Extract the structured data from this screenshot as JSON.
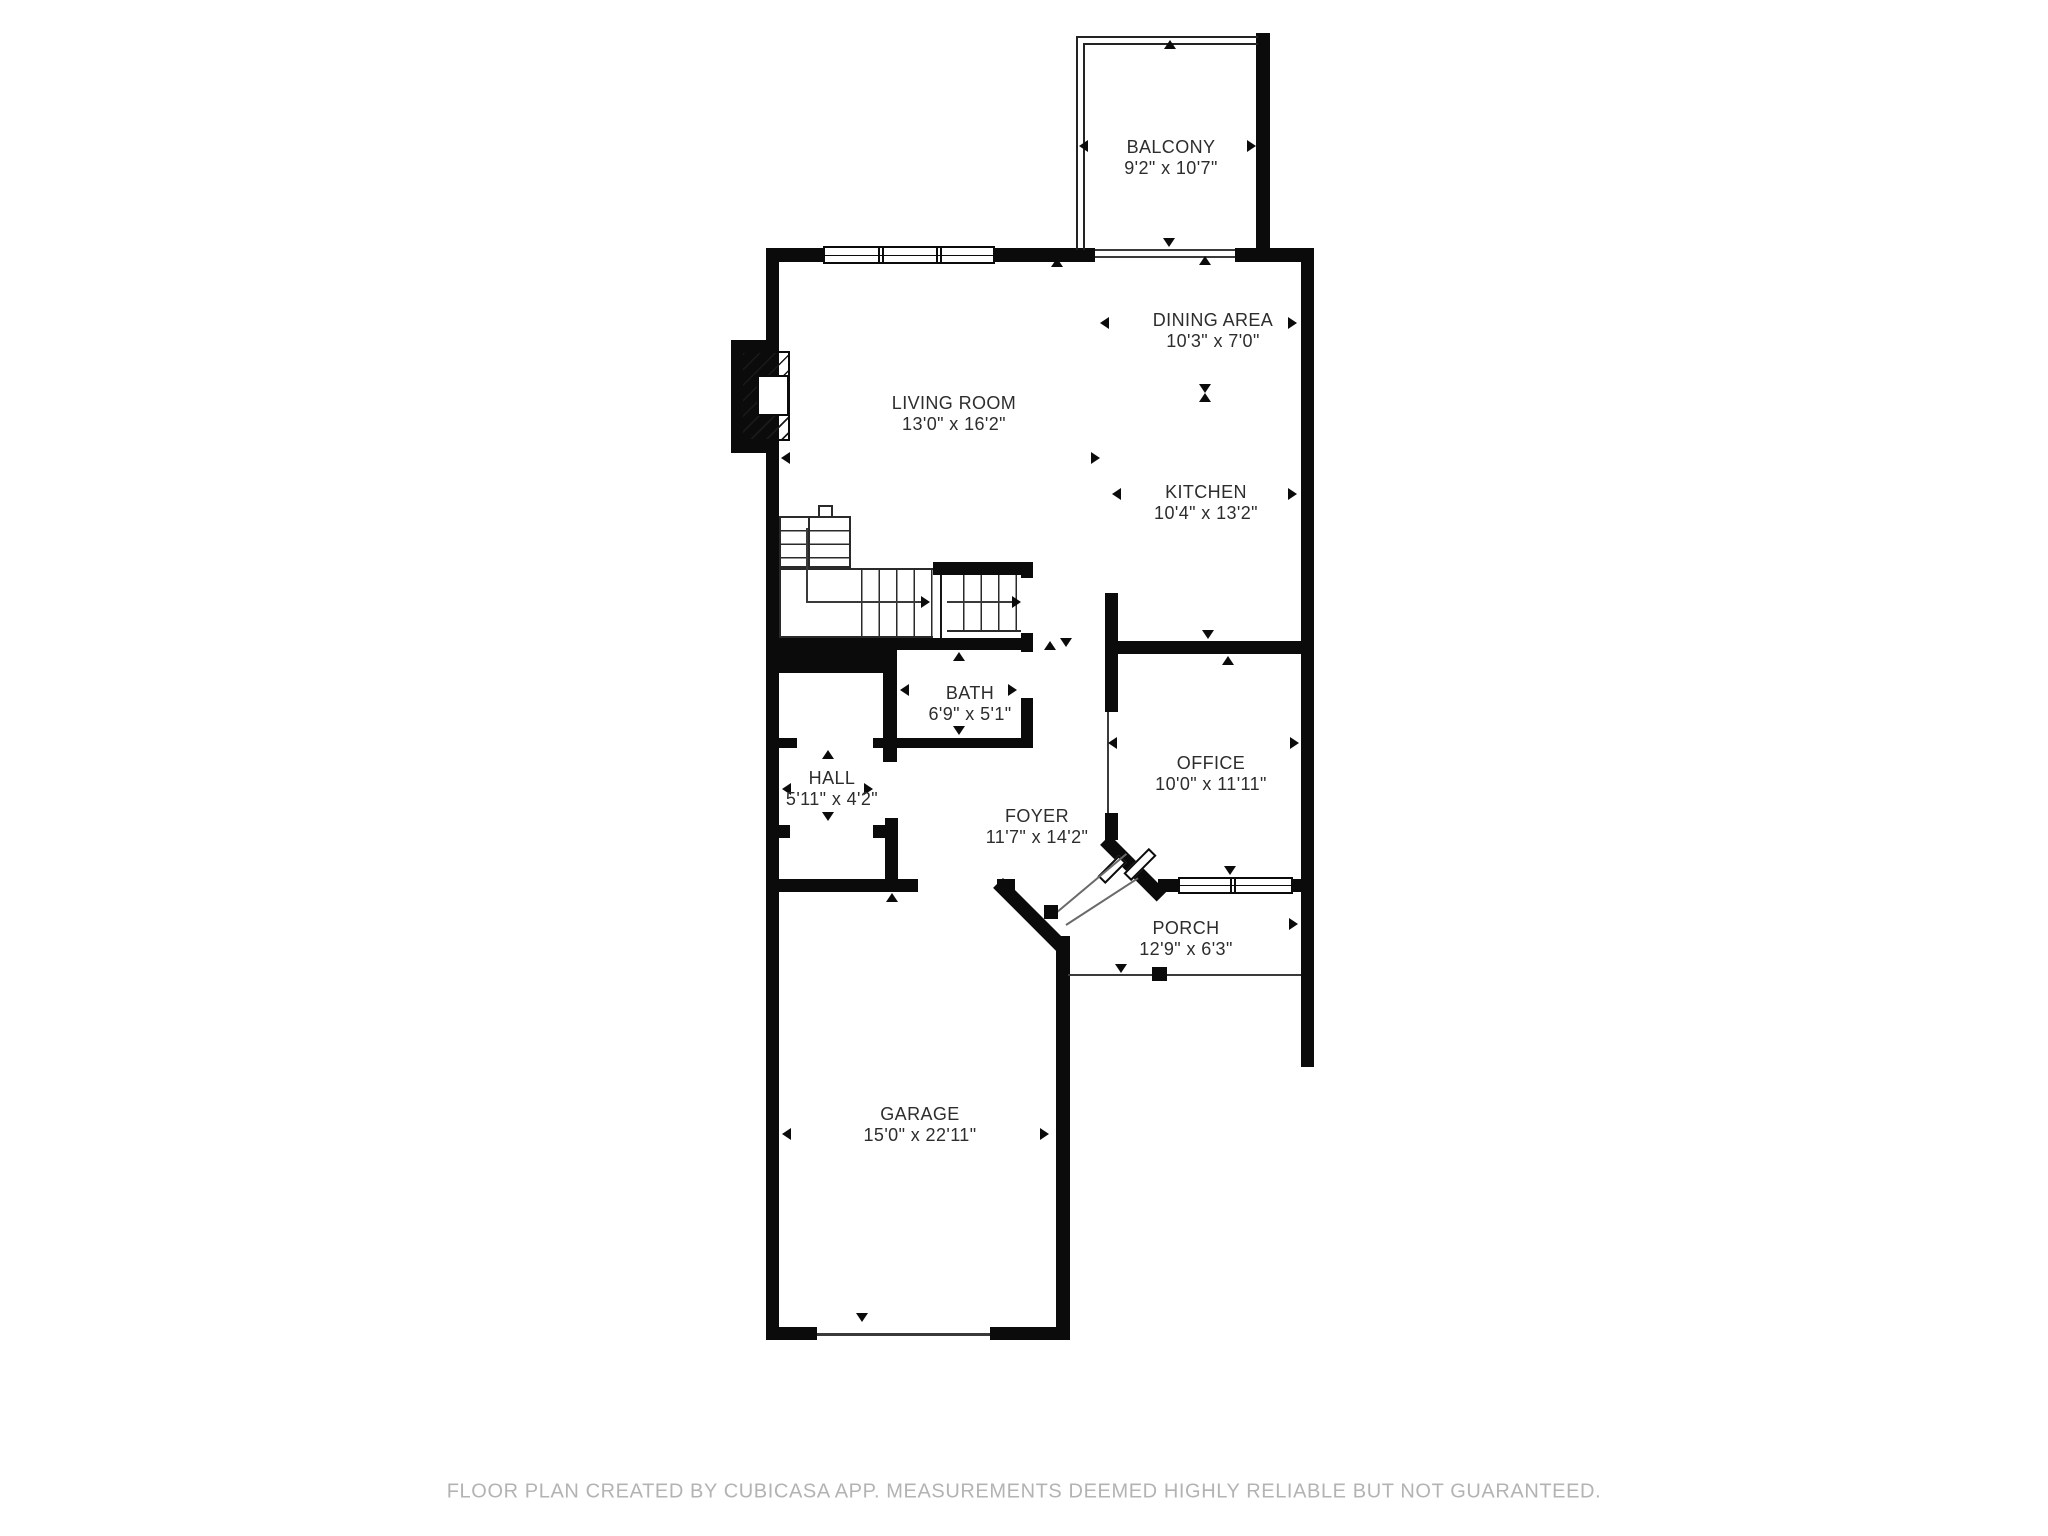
{
  "meta": {
    "type": "floor_plan",
    "colors": {
      "wall": "#0b0b0b",
      "background": "#ffffff",
      "label_text": "#2d2d2d",
      "footer_text": "#b3b3b3"
    }
  },
  "rooms": [
    {
      "id": "balcony",
      "name": "BALCONY",
      "dims": "9'2\" x 10'7\""
    },
    {
      "id": "dining",
      "name": "DINING AREA",
      "dims": "10'3\" x 7'0\""
    },
    {
      "id": "living",
      "name": "LIVING ROOM",
      "dims": "13'0\" x 16'2\""
    },
    {
      "id": "kitchen",
      "name": "KITCHEN",
      "dims": "10'4\" x 13'2\""
    },
    {
      "id": "bath",
      "name": "BATH",
      "dims": "6'9\" x 5'1\""
    },
    {
      "id": "hall",
      "name": "HALL",
      "dims": "5'11\" x 4'2\""
    },
    {
      "id": "foyer",
      "name": "FOYER",
      "dims": "11'7\" x 14'2\""
    },
    {
      "id": "office",
      "name": "OFFICE",
      "dims": "10'0\" x 11'11\""
    },
    {
      "id": "porch",
      "name": "PORCH",
      "dims": "12'9\" x 6'3\""
    },
    {
      "id": "garage",
      "name": "GARAGE",
      "dims": "15'0\" x 22'11\""
    }
  ],
  "footer": {
    "text": "FLOOR PLAN CREATED BY CUBICASA APP. MEASUREMENTS DEEMED HIGHLY RELIABLE BUT NOT GUARANTEED."
  }
}
